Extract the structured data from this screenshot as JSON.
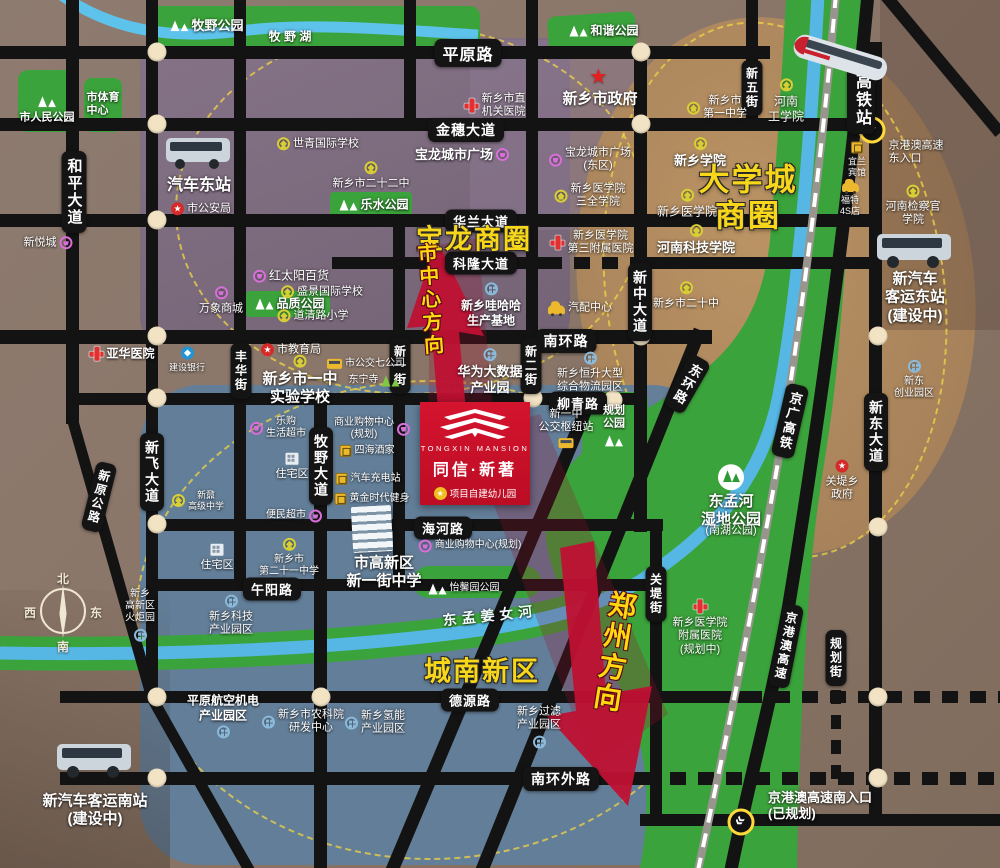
{
  "project": {
    "name_en": "TONGXIN MANSION",
    "name_cn": "同信·新著",
    "note": "项目自建幼儿园"
  },
  "compass": {
    "north": "北",
    "east": "东",
    "south": "南",
    "west": "西"
  },
  "business_circles": [
    {
      "text": "宝龙商圈",
      "x": 474,
      "y": 240,
      "fs": 27
    },
    {
      "text": "大学城\n商圈",
      "x": 748,
      "y": 198,
      "fs": 31
    },
    {
      "text": "城南新区",
      "x": 482,
      "y": 672,
      "fs": 27
    }
  ],
  "direction_arrows": [
    {
      "text": "市中心方向",
      "x": 429,
      "y": 300,
      "fs": 20,
      "rot": -4
    },
    {
      "text": "郑州方向",
      "x": 613,
      "y": 652,
      "fs": 28,
      "rot": 9
    }
  ],
  "road_labels": [
    {
      "t": "平原路",
      "x": 468,
      "y": 53,
      "o": "h",
      "fs": 16
    },
    {
      "t": "金穗大道",
      "x": 466,
      "y": 130,
      "o": "h",
      "fs": 14
    },
    {
      "t": "华兰大道",
      "x": 481,
      "y": 221,
      "o": "h",
      "fs": 13
    },
    {
      "t": "科隆大道",
      "x": 481,
      "y": 263,
      "o": "h",
      "fs": 13
    },
    {
      "t": "南环路",
      "x": 566,
      "y": 341,
      "o": "h",
      "fs": 14
    },
    {
      "t": "柳青路",
      "x": 578,
      "y": 403,
      "o": "h",
      "fs": 13
    },
    {
      "t": "海河路",
      "x": 443,
      "y": 528,
      "o": "h",
      "fs": 13
    },
    {
      "t": "午阳路",
      "x": 272,
      "y": 589,
      "o": "h",
      "fs": 13
    },
    {
      "t": "德源路",
      "x": 470,
      "y": 700,
      "o": "h",
      "fs": 13
    },
    {
      "t": "南环外路",
      "x": 561,
      "y": 779,
      "o": "h",
      "fs": 14
    },
    {
      "t": "和平大道",
      "x": 74,
      "y": 192,
      "o": "v",
      "fs": 15
    },
    {
      "t": "新飞大道",
      "x": 152,
      "y": 472,
      "o": "v",
      "fs": 14
    },
    {
      "t": "丰华街",
      "x": 241,
      "y": 371,
      "o": "v",
      "fs": 12
    },
    {
      "t": "牧野大道",
      "x": 321,
      "y": 466,
      "o": "v",
      "fs": 14
    },
    {
      "t": "新一街",
      "x": 400,
      "y": 366,
      "o": "v",
      "fs": 12
    },
    {
      "t": "新二街",
      "x": 531,
      "y": 366,
      "o": "v",
      "fs": 12
    },
    {
      "t": "新中大道",
      "x": 640,
      "y": 302,
      "o": "v",
      "fs": 14
    },
    {
      "t": "关堤街",
      "x": 656,
      "y": 594,
      "o": "v",
      "fs": 12
    },
    {
      "t": "新五街",
      "x": 752,
      "y": 88,
      "o": "v",
      "fs": 12
    },
    {
      "t": "新东大道",
      "x": 876,
      "y": 432,
      "o": "v",
      "fs": 14
    },
    {
      "t": "规划街",
      "x": 836,
      "y": 658,
      "o": "v",
      "fs": 12
    },
    {
      "t": "高铁站",
      "x": 861,
      "y": 100,
      "o": "v",
      "fs": 16
    },
    {
      "t": "新原公路",
      "x": 99,
      "y": 497,
      "o": "v",
      "r": 14,
      "fs": 12
    },
    {
      "t": "东环路",
      "x": 687,
      "y": 384,
      "o": "v",
      "r": 30,
      "fs": 13
    },
    {
      "t": "京广高铁",
      "x": 790,
      "y": 421,
      "o": "v",
      "r": 13,
      "fs": 13
    },
    {
      "t": "京港澳高速",
      "x": 786,
      "y": 646,
      "o": "v",
      "r": 11,
      "fs": 12
    }
  ],
  "landmarks": [
    {
      "t": "牧野公园",
      "x": 207,
      "y": 26,
      "ic": "trees",
      "ip": "left",
      "fs": 13,
      "b": 1
    },
    {
      "t": "牧 野 湖",
      "x": 290,
      "y": 37,
      "ic": "none",
      "fs": 12,
      "b": 1
    },
    {
      "t": "市人民公园",
      "x": 47,
      "y": 110,
      "ic": "trees",
      "ip": "top",
      "fs": 11,
      "b": 1
    },
    {
      "t": "市体育\n中心",
      "x": 103,
      "y": 105,
      "ic": "none",
      "fs": 11,
      "b": 1,
      "al": "left"
    },
    {
      "t": "和谐公园",
      "x": 604,
      "y": 31,
      "ic": "trees",
      "ip": "left",
      "fs": 12,
      "b": 1
    },
    {
      "t": "新乡市政府",
      "x": 600,
      "y": 88,
      "ic": "star",
      "ip": "top",
      "fs": 15,
      "b": 1
    },
    {
      "t": "新乡市直\n机关医院",
      "x": 495,
      "y": 106,
      "ic": "cross",
      "ip": "left",
      "fs": 11
    },
    {
      "t": "宝龙城市广场",
      "x": 462,
      "y": 155,
      "ic": "shop",
      "ip": "right",
      "fs": 13,
      "b": 1
    },
    {
      "t": "世青国际学校",
      "x": 318,
      "y": 144,
      "ic": "school",
      "ip": "left",
      "fs": 11
    },
    {
      "t": "新乡市二十二中",
      "x": 371,
      "y": 176,
      "ic": "school",
      "ip": "top",
      "fs": 11
    },
    {
      "t": "乐水公园",
      "x": 374,
      "y": 205,
      "ic": "trees",
      "ip": "left",
      "fs": 12,
      "b": 1
    },
    {
      "t": "汽车东站",
      "x": 199,
      "y": 186,
      "ic": "none",
      "fs": 16,
      "b": 1
    },
    {
      "t": "市公安局",
      "x": 201,
      "y": 209,
      "ic": "gov",
      "ip": "left",
      "fs": 11
    },
    {
      "t": "新悦城",
      "x": 48,
      "y": 243,
      "ic": "shop",
      "ip": "right",
      "fs": 11
    },
    {
      "t": "红太阳百货",
      "x": 291,
      "y": 276,
      "ic": "shop",
      "ip": "left",
      "fs": 12
    },
    {
      "t": "品质公园",
      "x": 290,
      "y": 304,
      "ic": "trees",
      "ip": "left",
      "fs": 12,
      "b": 1
    },
    {
      "t": "万象商城",
      "x": 221,
      "y": 301,
      "ic": "shop",
      "ip": "top",
      "fs": 11
    },
    {
      "t": "盛景国际学校",
      "x": 322,
      "y": 292,
      "ic": "school",
      "ip": "left",
      "fs": 11
    },
    {
      "t": "道清路小学",
      "x": 313,
      "y": 316,
      "ic": "school",
      "ip": "left",
      "fs": 11
    },
    {
      "t": "亚华医院",
      "x": 122,
      "y": 354,
      "ic": "cross",
      "ip": "left",
      "fs": 12,
      "b": 1
    },
    {
      "t": "建设银行",
      "x": 187,
      "y": 360,
      "ic": "bank",
      "ip": "top",
      "fs": 9
    },
    {
      "t": "市教育局",
      "x": 291,
      "y": 350,
      "ic": "gov",
      "ip": "left",
      "fs": 11
    },
    {
      "t": "新乡市一中\n实验学校",
      "x": 300,
      "y": 381,
      "ic": "school",
      "ip": "top",
      "fs": 15,
      "b": 1
    },
    {
      "t": "市公交七公司",
      "x": 366,
      "y": 364,
      "ic": "bus",
      "ip": "left",
      "fs": 10
    },
    {
      "t": "东宁寺",
      "x": 374,
      "y": 381,
      "ic": "trees",
      "ip": "right",
      "fs": 10,
      "cls": "green-tree"
    },
    {
      "t": "华为大数据\n产业园",
      "x": 490,
      "y": 372,
      "ic": "fact",
      "ip": "top",
      "fs": 13,
      "b": 1
    },
    {
      "t": "新乡哇哈哈\n生产基地",
      "x": 491,
      "y": 305,
      "ic": "fact",
      "ip": "top",
      "fs": 12,
      "b": 1
    },
    {
      "t": "汽配中心",
      "x": 580,
      "y": 308,
      "ic": "car",
      "ip": "left",
      "fs": 11
    },
    {
      "t": "新乡市二十中",
      "x": 686,
      "y": 296,
      "ic": "school",
      "ip": "top",
      "fs": 11
    },
    {
      "t": "新乡恒升大型\n综合物流园区",
      "x": 590,
      "y": 373,
      "ic": "fact",
      "ip": "top",
      "fs": 11
    },
    {
      "t": "新一中\n公交枢纽站",
      "x": 566,
      "y": 428,
      "ic": "bus",
      "ip": "bottom",
      "fs": 11
    },
    {
      "t": "规划\n公园",
      "x": 614,
      "y": 426,
      "ic": "trees",
      "ip": "bottom",
      "fs": 11,
      "b": 1
    },
    {
      "t": "乐购\n生活超市",
      "x": 278,
      "y": 428,
      "ic": "shop",
      "ip": "left",
      "fs": 10
    },
    {
      "t": "住宅区",
      "x": 292,
      "y": 467,
      "ic": "home",
      "ip": "top",
      "fs": 11
    },
    {
      "t": "商业购物中心\n(规划)",
      "x": 372,
      "y": 429,
      "ic": "shop",
      "ip": "right",
      "fs": 10
    },
    {
      "t": "四海酒家",
      "x": 367,
      "y": 451,
      "ic": "sq",
      "ip": "left",
      "fs": 10
    },
    {
      "t": "汽车充电站",
      "x": 368,
      "y": 479,
      "ic": "sq",
      "ip": "left",
      "fs": 10
    },
    {
      "t": "黄金时代健身",
      "x": 372,
      "y": 499,
      "ic": "sq",
      "ip": "left",
      "fs": 10
    },
    {
      "t": "新鼐\n高级中学",
      "x": 198,
      "y": 501,
      "ic": "school",
      "ip": "left",
      "fs": 9
    },
    {
      "t": "便民超市",
      "x": 294,
      "y": 516,
      "ic": "shop",
      "ip": "right",
      "fs": 10
    },
    {
      "t": "商业购物中心(规划)",
      "x": 470,
      "y": 546,
      "ic": "shop",
      "ip": "left",
      "fs": 10
    },
    {
      "t": "市高新区\n新一街中学",
      "x": 384,
      "y": 573,
      "ic": "none",
      "fs": 15,
      "b": 1
    },
    {
      "t": "新乡市\n第二十一中学",
      "x": 289,
      "y": 558,
      "ic": "school",
      "ip": "top",
      "fs": 10
    },
    {
      "t": "住宅区",
      "x": 217,
      "y": 558,
      "ic": "home",
      "ip": "top",
      "fs": 11
    },
    {
      "t": "怡馨园公园",
      "x": 464,
      "y": 589,
      "ic": "trees",
      "ip": "left",
      "fs": 10
    },
    {
      "t": "东孟河\n湿地公园",
      "x": 731,
      "y": 497,
      "ic": "wet",
      "ip": "top",
      "fs": 15,
      "b": 1
    },
    {
      "t": "(南湖公园)",
      "x": 731,
      "y": 531,
      "ic": "none",
      "fs": 11
    },
    {
      "t": "关堤乡\n政府",
      "x": 842,
      "y": 481,
      "ic": "gov",
      "ip": "top",
      "fs": 11
    },
    {
      "t": "新东\n创业园区",
      "x": 914,
      "y": 380,
      "ic": "fact",
      "ip": "top",
      "fs": 10
    },
    {
      "t": "新乡医学院\n附属医院\n(规划中)",
      "x": 700,
      "y": 628,
      "ic": "cross",
      "ip": "top",
      "fs": 11
    },
    {
      "t": "新乡\n高新区\n火炬园",
      "x": 140,
      "y": 615,
      "ic": "fact",
      "ip": "bottom",
      "fs": 10
    },
    {
      "t": "新乡科技\n产业园区",
      "x": 231,
      "y": 616,
      "ic": "fact",
      "ip": "top",
      "fs": 11
    },
    {
      "t": "平原航空机电\n产业园区",
      "x": 223,
      "y": 716,
      "ic": "fact",
      "ip": "bottom",
      "fs": 12,
      "b": 1
    },
    {
      "t": "新乡市农科院\n研发中心",
      "x": 303,
      "y": 722,
      "ic": "fact",
      "ip": "left",
      "fs": 11
    },
    {
      "t": "新乡氢能\n产业园区",
      "x": 375,
      "y": 723,
      "ic": "fact",
      "ip": "left",
      "fs": 11
    },
    {
      "t": "新乡过滤\n产业园区",
      "x": 539,
      "y": 727,
      "ic": "fact",
      "ip": "bottom",
      "fs": 11
    },
    {
      "t": "新汽车客运南站\n(建设中)",
      "x": 95,
      "y": 811,
      "ic": "none",
      "fs": 15,
      "b": 1
    },
    {
      "t": "东孟姜女河",
      "x": 490,
      "y": 616,
      "ic": "none",
      "fs": 14,
      "b": 1,
      "cls": "water",
      "r": -6
    },
    {
      "t": "新乡市\n第一中学",
      "x": 717,
      "y": 108,
      "ic": "school",
      "ip": "left",
      "fs": 11
    },
    {
      "t": "河南\n工学院",
      "x": 786,
      "y": 101,
      "ic": "school",
      "ip": "top",
      "fs": 12
    },
    {
      "t": "新乡学院",
      "x": 700,
      "y": 153,
      "ic": "school",
      "ip": "top",
      "fs": 13,
      "b": 1
    },
    {
      "t": "宝龙城市广场\n(东区)",
      "x": 590,
      "y": 160,
      "ic": "shop",
      "ip": "left",
      "fs": 11
    },
    {
      "t": "新乡医学院\n三全学院",
      "x": 590,
      "y": 196,
      "ic": "school",
      "ip": "left",
      "fs": 11
    },
    {
      "t": "新乡医学院",
      "x": 687,
      "y": 204,
      "ic": "school",
      "ip": "top",
      "fs": 12
    },
    {
      "t": "河南科技学院",
      "x": 696,
      "y": 240,
      "ic": "school",
      "ip": "top",
      "fs": 13,
      "b": 1
    },
    {
      "t": "新乡医学院\n第三附属医院",
      "x": 592,
      "y": 243,
      "ic": "cross",
      "ip": "left",
      "fs": 11
    },
    {
      "t": "河南检察官\n学院",
      "x": 913,
      "y": 206,
      "ic": "school",
      "ip": "top",
      "fs": 11
    },
    {
      "t": "宜兰\n宾馆",
      "x": 857,
      "y": 160,
      "ic": "sq",
      "ip": "top",
      "fs": 9
    },
    {
      "t": "福特\n4S店",
      "x": 850,
      "y": 198,
      "ic": "car",
      "ip": "top",
      "fs": 9
    },
    {
      "t": "新汽车\n客运东站\n(建设中)",
      "x": 915,
      "y": 298,
      "ic": "none",
      "fs": 15,
      "b": 1
    },
    {
      "t": "京港澳高速\n东入口",
      "x": 916,
      "y": 153,
      "ic": "none",
      "fs": 11,
      "al": "left"
    },
    {
      "t": "京港澳高速南入口\n(已规划)",
      "x": 820,
      "y": 806,
      "ic": "none",
      "fs": 13,
      "b": 1,
      "al": "left"
    }
  ],
  "colors": {
    "accent_red": "#cf1126",
    "park_green": "#3ba33b",
    "river_blue": "#56b7e5",
    "road_black": "#131313",
    "label_yellow": "#f8d71a",
    "zone_blue": "#617e9b",
    "zone_purple": "#7e6b82",
    "zone_tan": "#b89060"
  }
}
